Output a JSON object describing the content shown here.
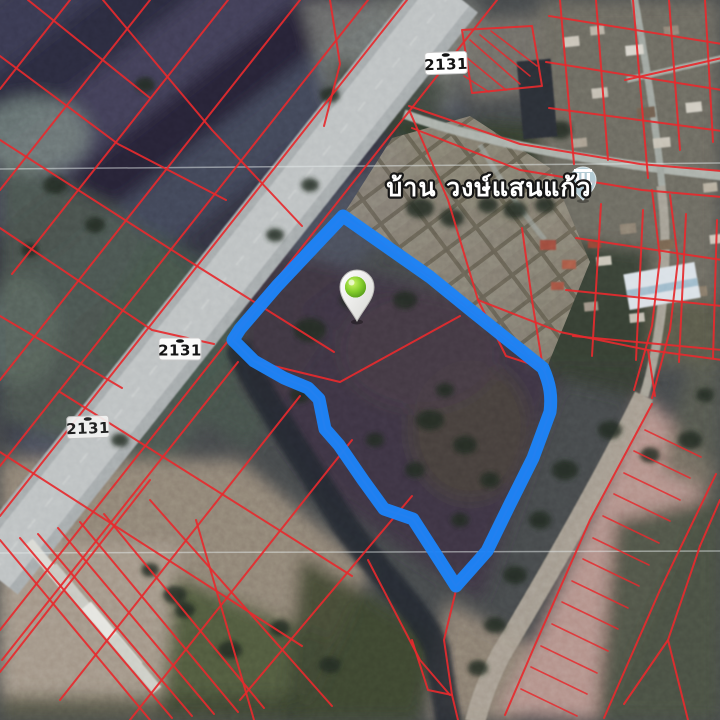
{
  "map": {
    "type": "satellite-cadastral-view",
    "place_label": "บ้าน วงษ์แสนแก้ว",
    "route_shields": [
      {
        "position": "top",
        "label": "2131"
      },
      {
        "position": "middle",
        "label": "2131"
      },
      {
        "position": "left",
        "label": "2131"
      }
    ],
    "icons": [
      "location-pin-icon",
      "historic-site-icon"
    ],
    "colors": {
      "parcel_line": "#e62a2e",
      "highlight": "#1d83f7",
      "pin_green": "#7cc623",
      "road": "#b6bbbc",
      "shield_bg": "#ffffff",
      "shield_text": "#141414",
      "label_text": "#ffffff"
    }
  }
}
